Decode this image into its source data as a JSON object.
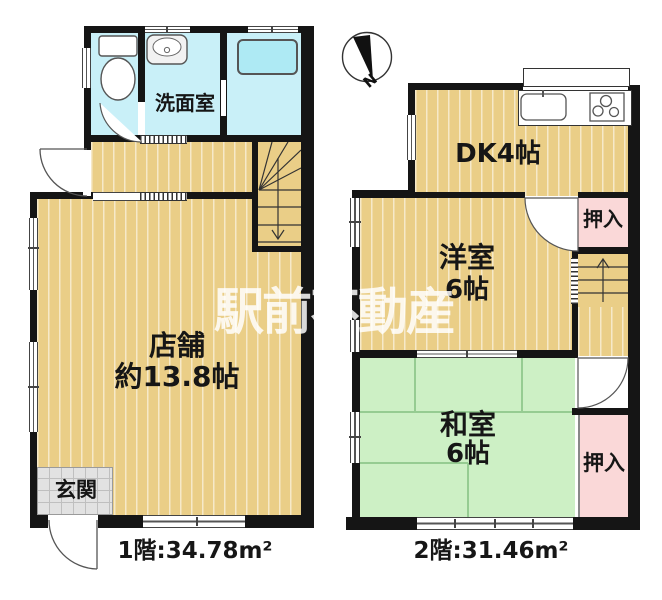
{
  "watermark": "駅前不動産",
  "compass": {
    "label": "N"
  },
  "floor1": {
    "washroom_label": "洗面室",
    "shop_label": "店舗",
    "shop_size": "約13.8帖",
    "entrance_label": "玄関",
    "area_label": "1階:34.78m²"
  },
  "floor2": {
    "dk_label": "DK4帖",
    "western_label": "洋室",
    "western_size": "6帖",
    "japanese_label": "和室",
    "japanese_size": "6帖",
    "closet_upper_label": "押入",
    "closet_lower_label": "押入",
    "area_label": "2階:31.46m²"
  },
  "colors": {
    "wood_floor": "#eace87",
    "wet_area": "#c9f0f8",
    "tatami": "#cdf0c5",
    "closet_pink": "#fad8d8",
    "wall": "#151515",
    "entrance_gray": "#e2e2e2"
  }
}
